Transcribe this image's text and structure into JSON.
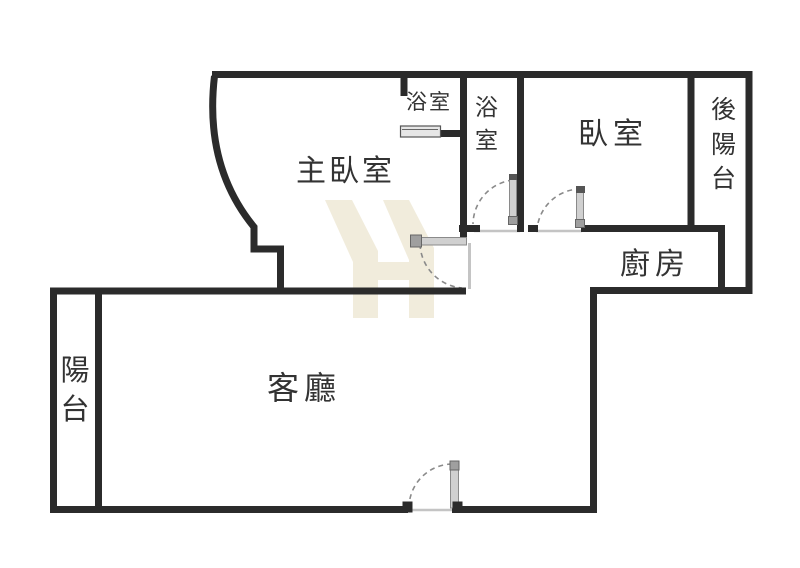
{
  "page": {
    "background": "#ffffff",
    "type": "floor-plan"
  },
  "rooms": {
    "master_bedroom": {
      "label": "主臥室"
    },
    "bathroom_1": {
      "label": "浴室"
    },
    "bathroom_2": {
      "label": "浴室"
    },
    "bedroom": {
      "label": "臥室"
    },
    "rear_balcony": {
      "label": "後陽台"
    },
    "kitchen": {
      "label": "廚房"
    },
    "living_room": {
      "label": "客廳"
    },
    "balcony": {
      "label": "陽台"
    }
  },
  "colors": {
    "wall": "#2b2b2b",
    "door_leaf": "#d0d0d0",
    "door_arc": "#8a8a8a",
    "threshold": "#c4c4c4",
    "watermark": "#f1ecdc",
    "label_text": "#333333"
  }
}
